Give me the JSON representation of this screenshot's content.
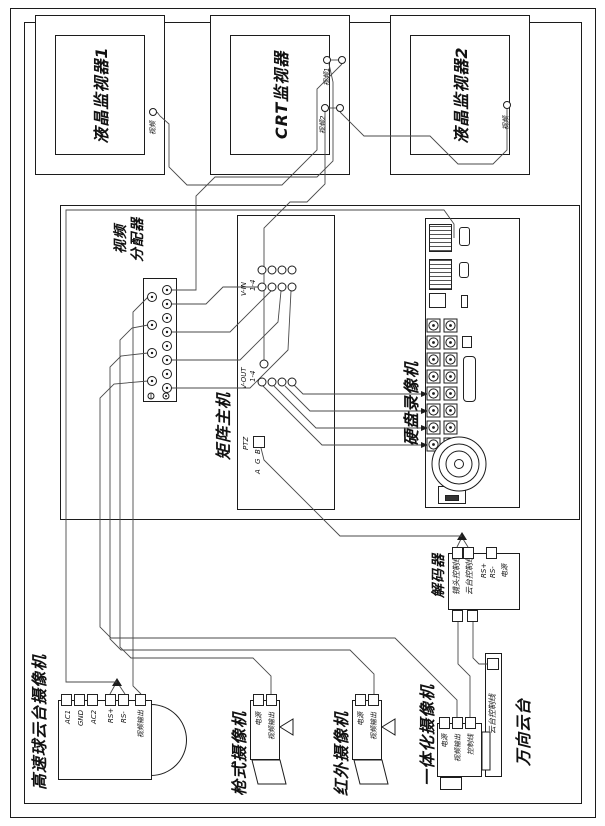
{
  "diagram": {
    "monitors": [
      {
        "name": "液晶监视器1",
        "ports": [
          {
            "label": "视频"
          }
        ]
      },
      {
        "name": "CRT监视器",
        "ports": [
          {
            "label": "视频1"
          },
          {
            "label": "视频2"
          }
        ]
      },
      {
        "name": "液晶监视器2",
        "ports": [
          {
            "label": "视频"
          }
        ]
      }
    ],
    "distributor": {
      "label_line1": "视频",
      "label_line2": "分配器"
    },
    "matrix": {
      "label": "矩阵主机",
      "vin": "V-IN",
      "vin_range": "1-4",
      "vout": "V-OUT",
      "vout_range": "1-4",
      "ptz": "PTZ",
      "bus": [
        "A",
        "G",
        "B"
      ]
    },
    "dvr": {
      "label": "硬盘录像机"
    },
    "decoder": {
      "label": "解码器",
      "lines": [
        "镜头控制线",
        "云台控制线"
      ],
      "ports": [
        "RS+",
        "RS-",
        "电源"
      ]
    },
    "ball_camera": {
      "label": "高速球云台摄像机",
      "terminals": [
        "AC1",
        "GND",
        "AC2",
        "RS+",
        "RS-",
        "视频输出"
      ]
    },
    "gun_camera": {
      "label": "枪式摄像机",
      "terminals": [
        "电源",
        "视频输出"
      ]
    },
    "ir_camera": {
      "label": "红外摄像机",
      "terminals": [
        "电源",
        "视频输出"
      ]
    },
    "integrated_camera": {
      "label": "一体化摄像机",
      "terminals": [
        "电源",
        "视频输出",
        "控制线"
      ]
    },
    "pan_tilt": {
      "label": "万向云台",
      "port": "云台控制线"
    }
  }
}
